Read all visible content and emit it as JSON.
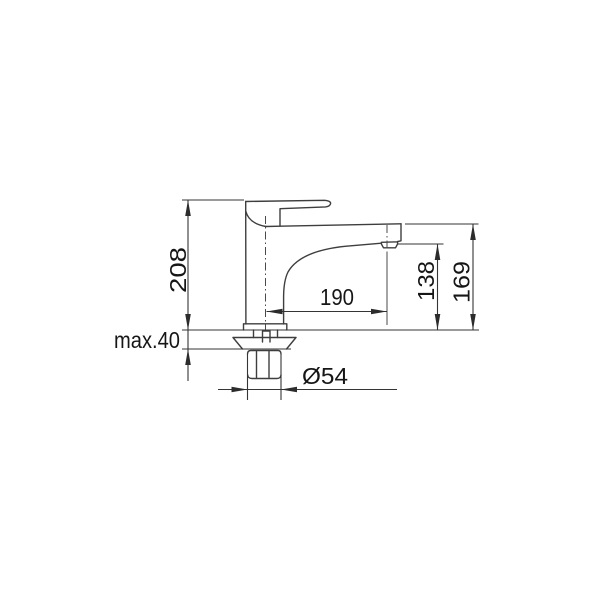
{
  "drawing": {
    "type": "technical-dimension-drawing",
    "subject": "single-lever pillar faucet, side elevation with mounting hardware",
    "background_color": "#ffffff",
    "line_color": "#3e3e3e",
    "text_color": "#161616",
    "dimensions": {
      "total_height": {
        "label": "208",
        "orientation": "vertical",
        "measures": "deck to top of lever"
      },
      "deck_thickness": {
        "label": "max.40",
        "orientation": "horizontal",
        "measures": "maximum mounting deck thickness"
      },
      "spout_reach": {
        "label": "190",
        "orientation": "horizontal",
        "measures": "body axis to outlet axis"
      },
      "outlet_height": {
        "label": "138",
        "orientation": "vertical",
        "measures": "deck to outlet underside"
      },
      "spout_top_height": {
        "label": "169",
        "orientation": "vertical",
        "measures": "deck to top of spout"
      },
      "base_diameter": {
        "label": "Ø54",
        "orientation": "horizontal",
        "measures": "base / shank diameter"
      }
    }
  }
}
